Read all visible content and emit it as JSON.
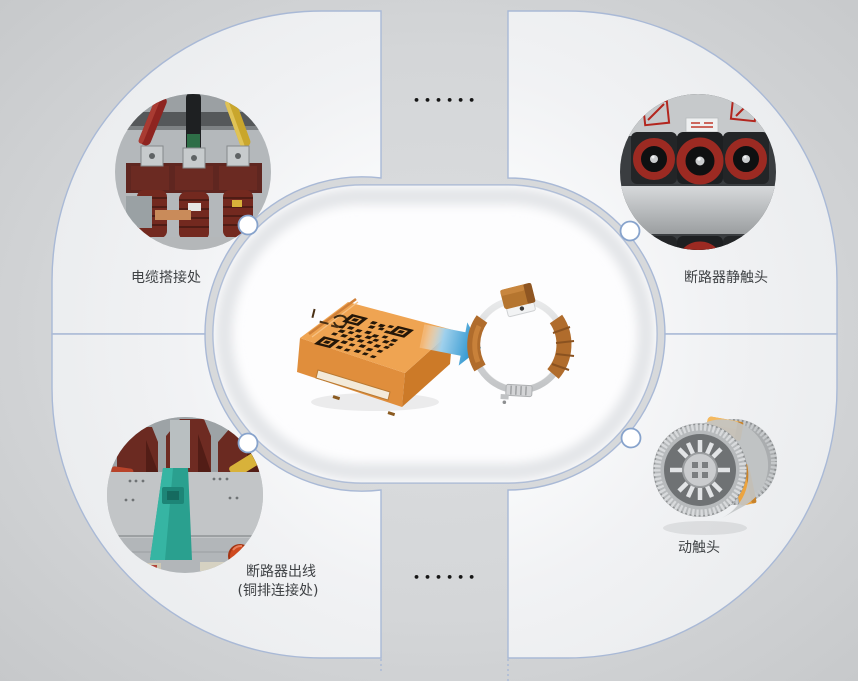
{
  "diagram": {
    "name": "sensor-installation-positions",
    "labels": {
      "top_left": "电缆搭接处",
      "top_right": "断路器静触头",
      "bottom_left_line1": "断路器出线",
      "bottom_left_line2": "(铜排连接处)",
      "bottom_right": "动触头"
    },
    "separators": {
      "top": "••••••",
      "bottom": "••••••"
    },
    "center": {
      "items": [
        "wireless-temperature-sensor",
        "install-arrow",
        "clamp-ring-with-sensor"
      ],
      "icons": [
        "qr-code-icon",
        "brand-logo-icon",
        "arrow-right-icon"
      ]
    },
    "hotspots": [
      {
        "id": "cable-joint",
        "position": "top-left",
        "label": "电缆搭接处",
        "media": "photo"
      },
      {
        "id": "breaker-static-contact",
        "position": "top-right",
        "label": "断路器静触头",
        "media": "photo"
      },
      {
        "id": "breaker-outlet-busbar",
        "position": "bottom-left",
        "label": "断路器出线 (铜排连接处)",
        "media": "photo"
      },
      {
        "id": "moving-contact",
        "position": "bottom-right",
        "label": "动触头",
        "media": "3d-render"
      }
    ],
    "colors": {
      "background": "#c9cbcd",
      "quadrant_fill": "#eff0f2",
      "border_blue": "#a9b9d6",
      "capsule_white": "#fdfdfe",
      "arrow_blue": "#1b8ccb",
      "sensor_orange": "#eda14e",
      "clamp_orange": "#b06c2c",
      "label_text": "#3f4245",
      "separator_dots": "#161616"
    }
  }
}
